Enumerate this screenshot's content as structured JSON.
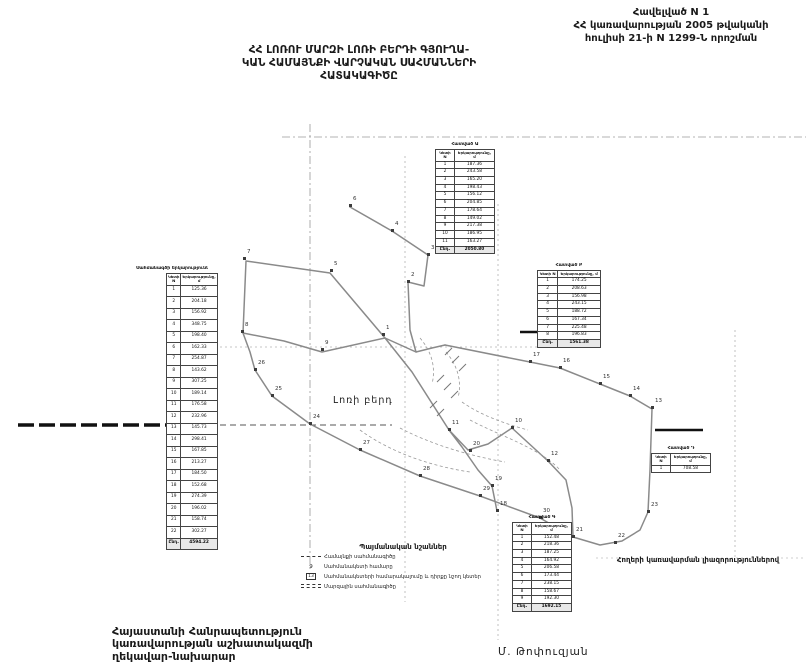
{
  "appendix": {
    "line1": "Հավելված N 1",
    "line2": "ՀՀ կառավարության 2005 թվականի",
    "line3": "հուլիսի 21-ի N 1299-Ն որոշման"
  },
  "title": {
    "line1": "ՀՀ ԼՈՌՈՒ ՄԱՐԶԻ ԼՈՌԻ ԲԵՐԴԻ ԳՅՈՒՂԱ-",
    "line2": "ԿԱՆ ՀԱՄԱՅՆՔԻ ՎԱՐՉԱԿԱՆ ՍԱՀՄԱՆՆԵՐԻ",
    "line3": "ՀԱՏԱԿԱԳԻԾԸ"
  },
  "map": {
    "place_label": "Լոռի բերդ",
    "points": [
      {
        "n": "1",
        "x": 383,
        "y": 334
      },
      {
        "n": "2",
        "x": 408,
        "y": 281
      },
      {
        "n": "3",
        "x": 428,
        "y": 254
      },
      {
        "n": "4",
        "x": 392,
        "y": 230
      },
      {
        "n": "5",
        "x": 331,
        "y": 270
      },
      {
        "n": "6",
        "x": 350,
        "y": 205
      },
      {
        "n": "7",
        "x": 244,
        "y": 258
      },
      {
        "n": "8",
        "x": 242,
        "y": 331
      },
      {
        "n": "9",
        "x": 322,
        "y": 349
      },
      {
        "n": "10",
        "x": 512,
        "y": 427
      },
      {
        "n": "11",
        "x": 449,
        "y": 429
      },
      {
        "n": "12",
        "x": 548,
        "y": 460
      },
      {
        "n": "13",
        "x": 652,
        "y": 407
      },
      {
        "n": "14",
        "x": 630,
        "y": 395
      },
      {
        "n": "15",
        "x": 600,
        "y": 383
      },
      {
        "n": "16",
        "x": 560,
        "y": 367
      },
      {
        "n": "17",
        "x": 530,
        "y": 361
      },
      {
        "n": "18",
        "x": 497,
        "y": 510
      },
      {
        "n": "19",
        "x": 492,
        "y": 485
      },
      {
        "n": "20",
        "x": 470,
        "y": 450
      },
      {
        "n": "21",
        "x": 573,
        "y": 536
      },
      {
        "n": "22",
        "x": 615,
        "y": 542
      },
      {
        "n": "23",
        "x": 648,
        "y": 511
      },
      {
        "n": "24",
        "x": 310,
        "y": 423
      },
      {
        "n": "25",
        "x": 272,
        "y": 395
      },
      {
        "n": "26",
        "x": 255,
        "y": 369
      },
      {
        "n": "27",
        "x": 360,
        "y": 449
      },
      {
        "n": "28",
        "x": 420,
        "y": 475
      },
      {
        "n": "29",
        "x": 480,
        "y": 495
      },
      {
        "n": "30",
        "x": 540,
        "y": 517
      }
    ]
  },
  "tables": [
    {
      "id": "left",
      "title": "Սահմանագծի երկարությունները",
      "headers": [
        "Կետի N",
        "Երկարությունը, մ"
      ],
      "rows": [
        [
          "1",
          "125.36"
        ],
        [
          "2",
          "204.18"
        ],
        [
          "3",
          "156.92"
        ],
        [
          "4",
          "348.75"
        ],
        [
          "5",
          "198.40"
        ],
        [
          "6",
          "162.33"
        ],
        [
          "7",
          "254.87"
        ],
        [
          "8",
          "143.62"
        ],
        [
          "9",
          "307.25"
        ],
        [
          "10",
          "189.14"
        ],
        [
          "11",
          "176.58"
        ],
        [
          "12",
          "232.96"
        ],
        [
          "13",
          "145.73"
        ],
        [
          "14",
          "298.41"
        ],
        [
          "15",
          "167.85"
        ],
        [
          "16",
          "213.27"
        ],
        [
          "17",
          "184.50"
        ],
        [
          "18",
          "152.68"
        ],
        [
          "19",
          "274.39"
        ],
        [
          "20",
          "196.02"
        ],
        [
          "21",
          "158.74"
        ],
        [
          "22",
          "302.27"
        ]
      ],
      "total": [
        "Ընդ.",
        "4594.22"
      ]
    },
    {
      "id": "topc",
      "title": "Հատված Ա",
      "headers": [
        "Կետի N",
        "Երկարությունը, մ"
      ],
      "rows": [
        [
          "1",
          "187.36"
        ],
        [
          "2",
          "243.58"
        ],
        [
          "3",
          "165.20"
        ],
        [
          "4",
          "198.43"
        ],
        [
          "5",
          "156.12"
        ],
        [
          "6",
          "204.85"
        ],
        [
          "7",
          "178.64"
        ],
        [
          "8",
          "149.02"
        ],
        [
          "9",
          "217.38"
        ],
        [
          "10",
          "186.95"
        ],
        [
          "11",
          "163.27"
        ]
      ],
      "total": [
        "Ընդ.",
        "2050.80"
      ]
    },
    {
      "id": "right",
      "title": "Հատված Բ",
      "headers": [
        "Կետի N",
        "Երկարությունը, մ"
      ],
      "rows": [
        [
          "1",
          "174.25"
        ],
        [
          "2",
          "208.63"
        ],
        [
          "3",
          "156.98"
        ],
        [
          "4",
          "243.15"
        ],
        [
          "5",
          "188.72"
        ],
        [
          "6",
          "167.34"
        ],
        [
          "7",
          "225.48"
        ],
        [
          "8",
          "196.83"
        ]
      ],
      "total": [
        "Ընդ.",
        "1561.38"
      ]
    },
    {
      "id": "botc",
      "title": "Հատված Գ",
      "headers": [
        "Կետի N",
        "Երկարությունը, մ"
      ],
      "rows": [
        [
          "1",
          "152.48"
        ],
        [
          "2",
          "218.36"
        ],
        [
          "3",
          "187.25"
        ],
        [
          "4",
          "164.92"
        ],
        [
          "5",
          "206.58"
        ],
        [
          "6",
          "173.44"
        ],
        [
          "7",
          "238.15"
        ],
        [
          "8",
          "158.67"
        ],
        [
          "9",
          "192.30"
        ]
      ],
      "total": [
        "Ընդ.",
        "1692.15"
      ]
    },
    {
      "id": "small",
      "title": "Հատված Դ",
      "headers": [
        "Կետի N",
        "Երկարությունը, մ"
      ],
      "rows": [
        [
          "1",
          "708.58"
        ]
      ],
      "total": null
    }
  ],
  "legend": {
    "title": "Պայմանական նշաններ",
    "items": [
      {
        "symbol": "boundary-line",
        "symbol_text": "",
        "label": "Համայնքի սահմանագիծը"
      },
      {
        "symbol": "point-number",
        "symbol_text": "9",
        "label": "Սահմանակետի համարը"
      },
      {
        "symbol": "point-box",
        "symbol_text": "13",
        "label": "Սահմանակետերի համարակալումը և դիրքը նշող կետեր"
      },
      {
        "symbol": "region-line",
        "symbol_text": "",
        "label": "Մարզային սահմանագիծը"
      }
    ]
  },
  "signatures": {
    "left_block": {
      "line1": "Հայաստանի Հանրապետություն",
      "line2": "կառավարության աշխատակազմի",
      "line3": "ղեկավար-նախարար"
    },
    "name": "Մ. Թոփուզյան",
    "right_note": "Հողերի կառավարման լիազորություններով"
  },
  "colors": {
    "boundary": "#8a8a8a",
    "grid": "#9a9a9a",
    "bold_line": "#111111",
    "text": "#1a1a1a"
  }
}
